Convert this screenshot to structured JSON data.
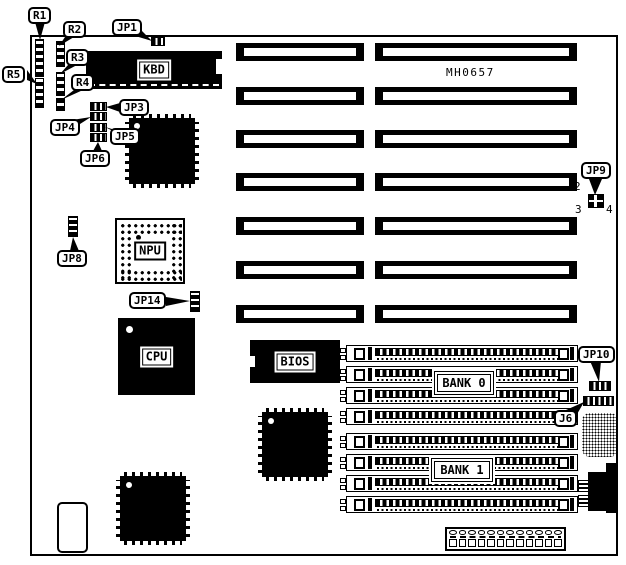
{
  "diagram": {
    "part_number": "MH0657"
  },
  "colors": {
    "ink": "#000000",
    "paper": "#ffffff"
  },
  "chips": {
    "kbd": "KBD",
    "npu": "NPU",
    "cpu": "CPU",
    "bios": "BIOS"
  },
  "banks": {
    "bank0": "BANK 0",
    "bank1": "BANK 1"
  },
  "callouts": {
    "r1": "R1",
    "r2": "R2",
    "r3": "R3",
    "r4": "R4",
    "r5": "R5",
    "jp1": "JP1",
    "jp3": "JP3",
    "jp4": "JP4",
    "jp5": "JP5",
    "jp6": "JP6",
    "jp8": "JP8",
    "jp9": "JP9",
    "jp10": "JP10",
    "jp14": "JP14",
    "j6": "J6"
  },
  "jp9_pins": {
    "p2": "2",
    "p3": "3",
    "p4": "4"
  }
}
